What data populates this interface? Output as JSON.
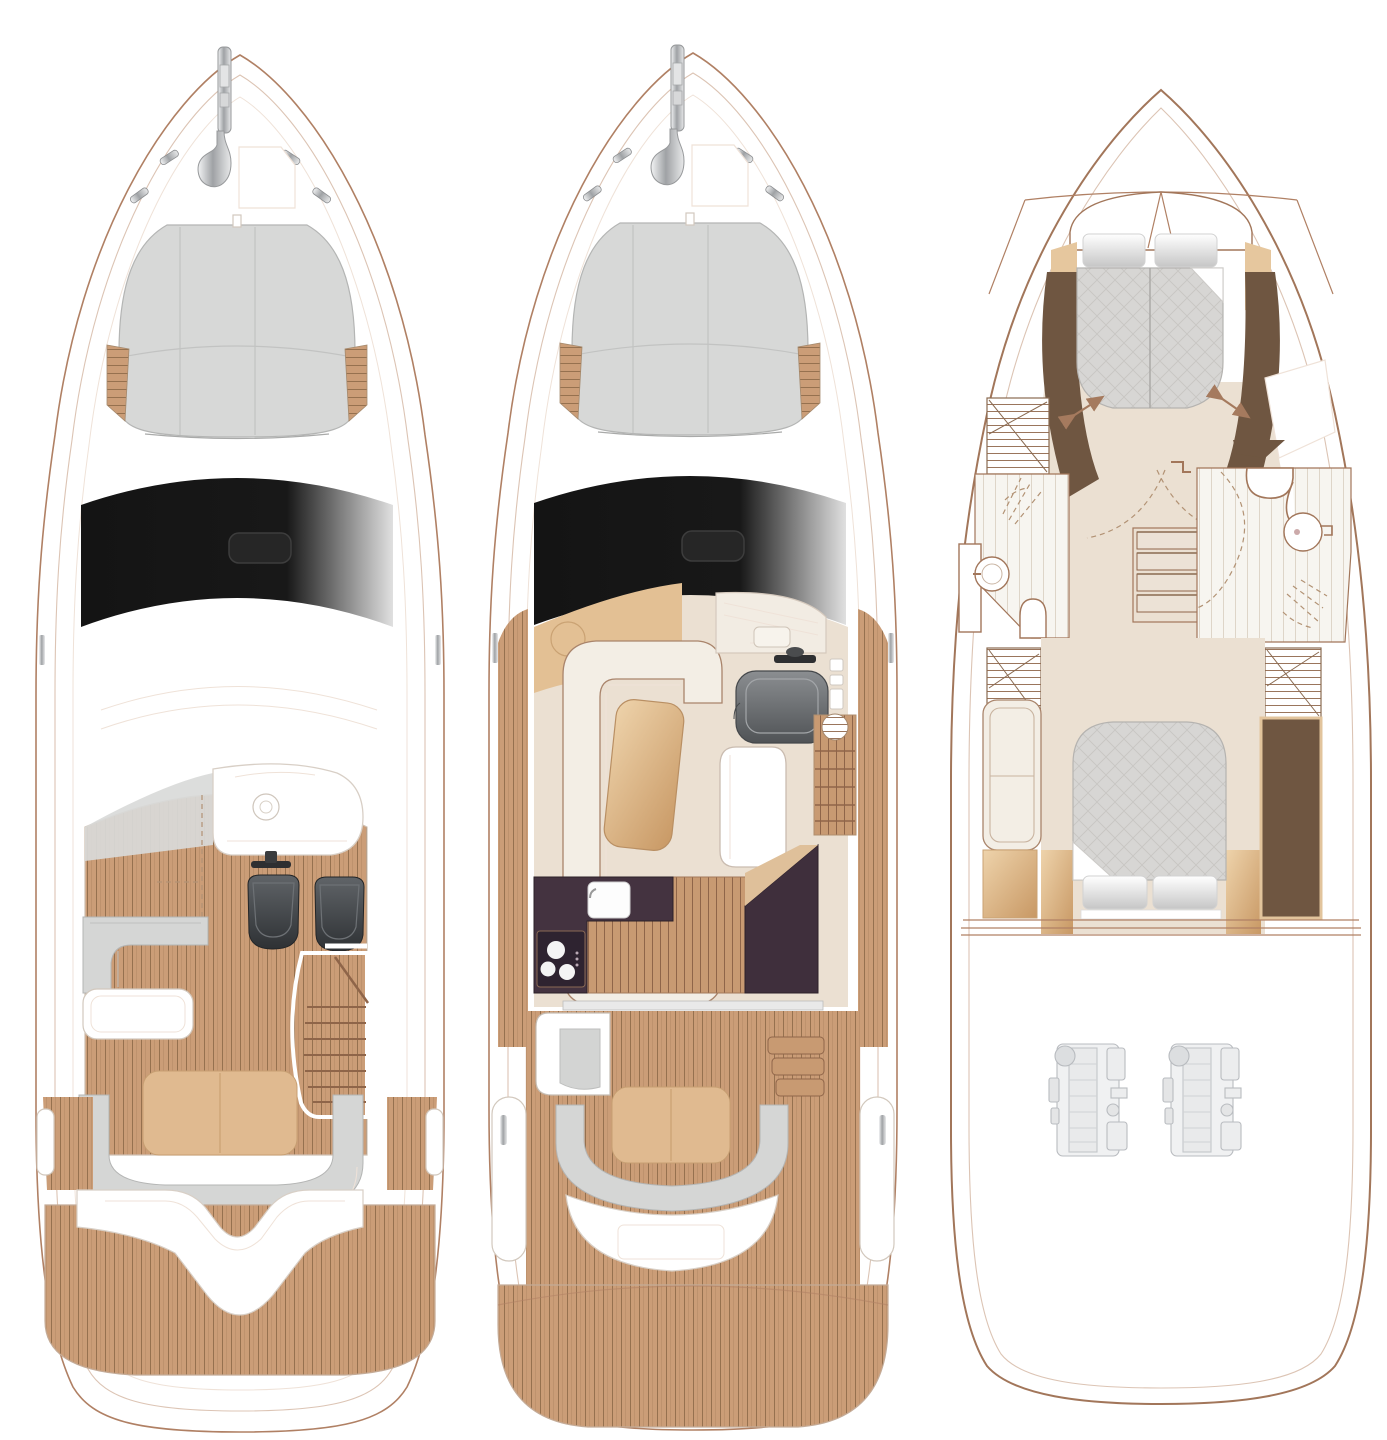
{
  "page": {
    "background_color": "#ffffff"
  },
  "diagram": {
    "type": "yacht-deck-plans",
    "views": [
      {
        "id": "flybridge-deck",
        "label": "Flybridge deck plan",
        "features": [
          "anchor",
          "bow-sunpad",
          "windscreen",
          "hardtop",
          "helm-console",
          "twin-helm-seats",
          "wet-bar-top",
          "l-shaped-sofa",
          "table",
          "stairway-to-cockpit",
          "aft-sunpad",
          "wraparound-bench",
          "transom-walkway",
          "teak-swim-platform"
        ]
      },
      {
        "id": "main-deck",
        "label": "Main deck plan",
        "features": [
          "anchor",
          "bow-sunpad",
          "windscreen",
          "u-shaped-salon-sofa",
          "salon-table",
          "dashboard",
          "steering-wheel",
          "helm-seat",
          "companionway-steps",
          "galley-counter",
          "galley-sink",
          "three-burner-cooktop",
          "pantry-unit",
          "cockpit-wet-bar",
          "side-deck-steps",
          "cockpit-table",
          "curved-cockpit-bench",
          "transom-seat",
          "teak-swim-platform"
        ]
      },
      {
        "id": "lower-deck",
        "label": "Lower deck plan",
        "features": [
          "forward-cabin-double-bed",
          "pillows",
          "hanging-wardrobes",
          "shower-room",
          "toilet",
          "round-washbasin",
          "door-swing-arcs",
          "central-staircase",
          "day-head",
          "aft-cabin-double-bed",
          "aft-cabin-sofa",
          "tall-wardrobe",
          "twin-engines"
        ]
      }
    ],
    "counts": {
      "deck_views": 3,
      "cabins": 2,
      "bathrooms": 2,
      "engines": 2,
      "helm_seats_flybridge": 2
    }
  },
  "colors": {
    "page_bg": "#ffffff",
    "outline": "#b08064",
    "outline3": "#a2765a",
    "outline_light": "#dcc4b4",
    "outline_faint": "#efe2d8",
    "teak": "#cb9d77",
    "teak_line": "#96714f",
    "wood": "#c89a72",
    "wood_line": "#8f6549",
    "plank": "#f7f5f0",
    "plank_line": "#ded5c8",
    "cushion": "#d5d6d5",
    "tan_pad": "#e0ba90",
    "cream_floor": "#ebe0d2",
    "cream_sofa": "#f3eee5",
    "sofa_line": "#a9846b",
    "galley_dark": "#443340",
    "galley_darker": "#2e2330",
    "brown_dark": "#6f5641",
    "glass_black": "#161616",
    "metal": "#c9cbcd",
    "seat_black": "#34373a",
    "arrow": "#a57a5e",
    "engine_line": "#b9bcc0"
  }
}
